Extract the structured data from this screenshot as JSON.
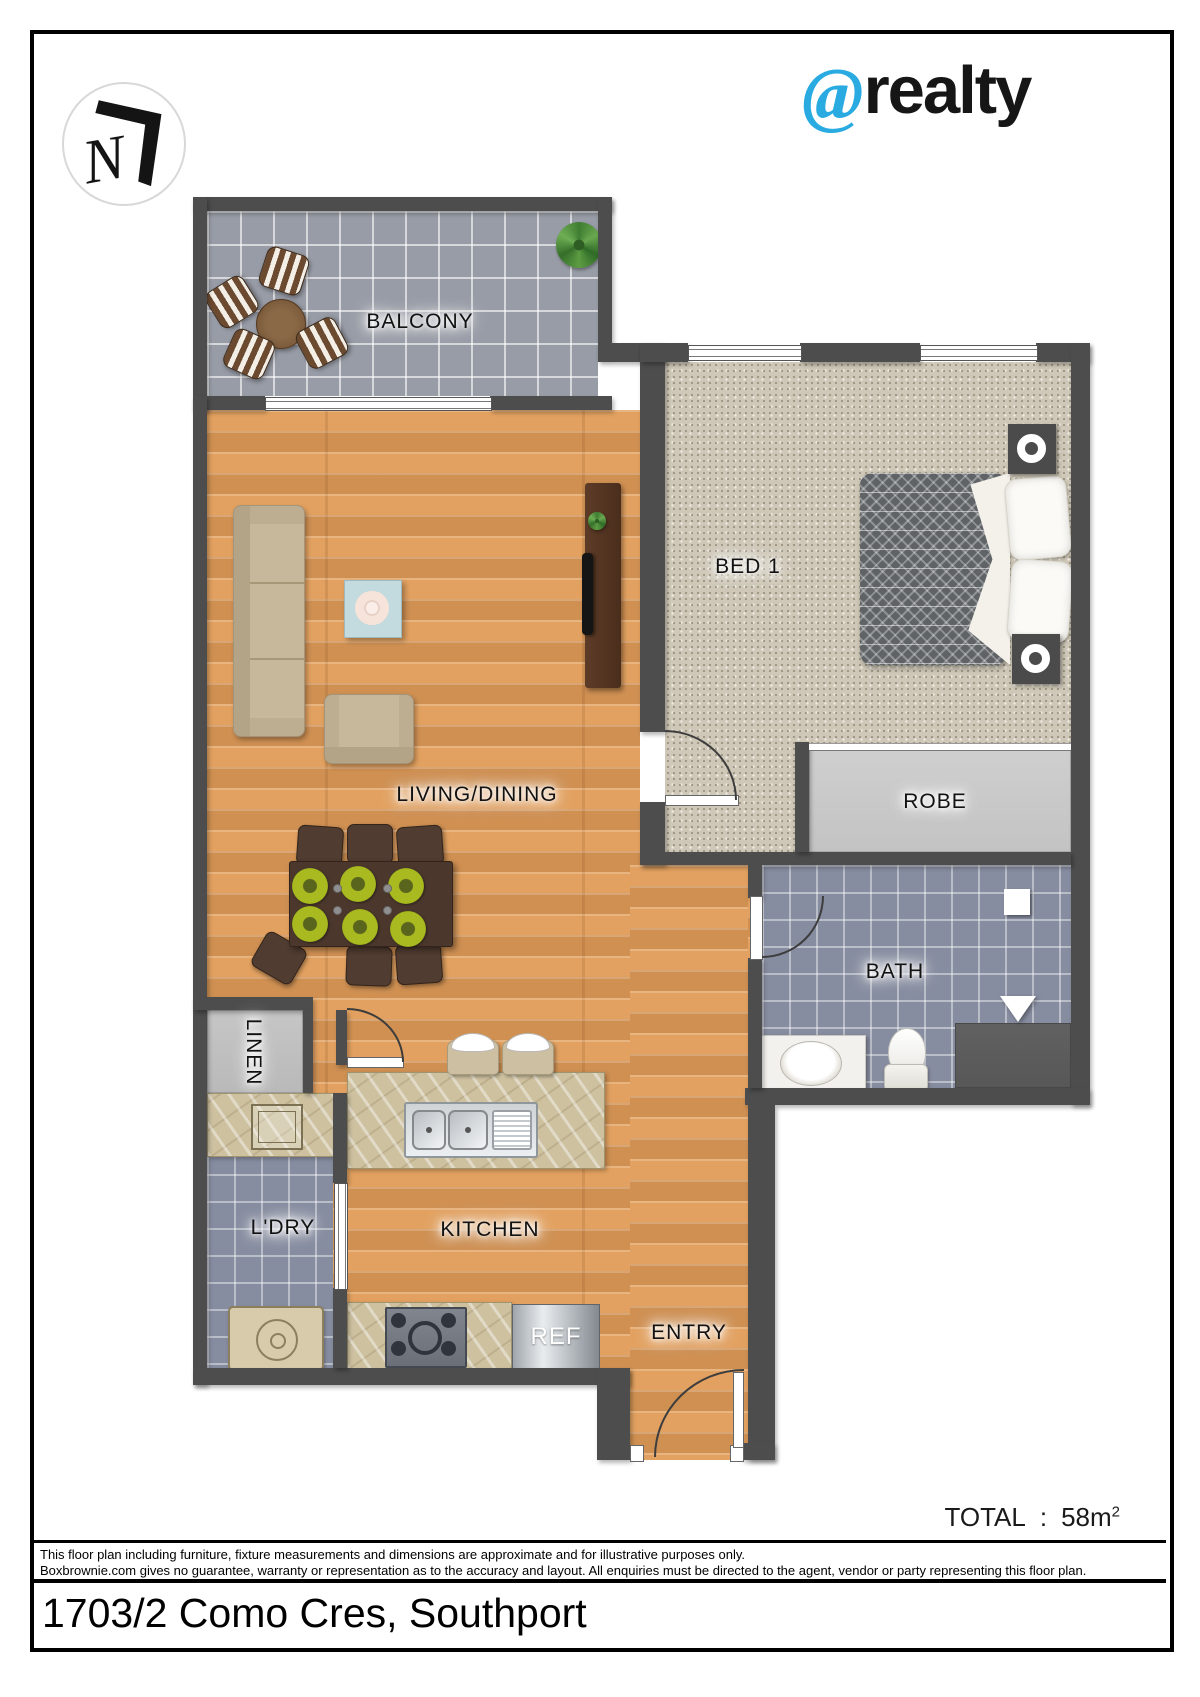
{
  "brand": {
    "at": "@",
    "name": "realty"
  },
  "logo": {
    "mark": "N"
  },
  "rooms": {
    "balcony": "BALCONY",
    "bed1": "BED 1",
    "living": "LIVING/DINING",
    "robe": "ROBE",
    "bath": "BATH",
    "linen": "LINEN",
    "laundry": "L'DRY",
    "kitchen": "KITCHEN",
    "fridge": "REF",
    "entry": "ENTRY"
  },
  "summary": {
    "label": "TOTAL",
    "separator": ":",
    "value": "58m",
    "superscript": "2"
  },
  "footer": {
    "disclaimer_line1": "This floor plan including furniture, fixture measurements and dimensions are approximate and for illustrative purposes only.",
    "disclaimer_line2": "Boxbrownie.com gives no guarantee, warranty or representation as to the accuracy and layout. All enquiries must be directed to the agent, vendor or party representing this floor plan.",
    "address": "1703/2 Como Cres, Southport"
  },
  "colors": {
    "brand_blue": "#29abe2",
    "wall": "#4d4d4d",
    "wood": "#e2a160",
    "carpet": "#cfc8b8",
    "balcony_tile": "#989ca6",
    "bath_tile": "#878da0",
    "robe": "#c8c8c8",
    "benchtop": "#cdc1a0"
  }
}
